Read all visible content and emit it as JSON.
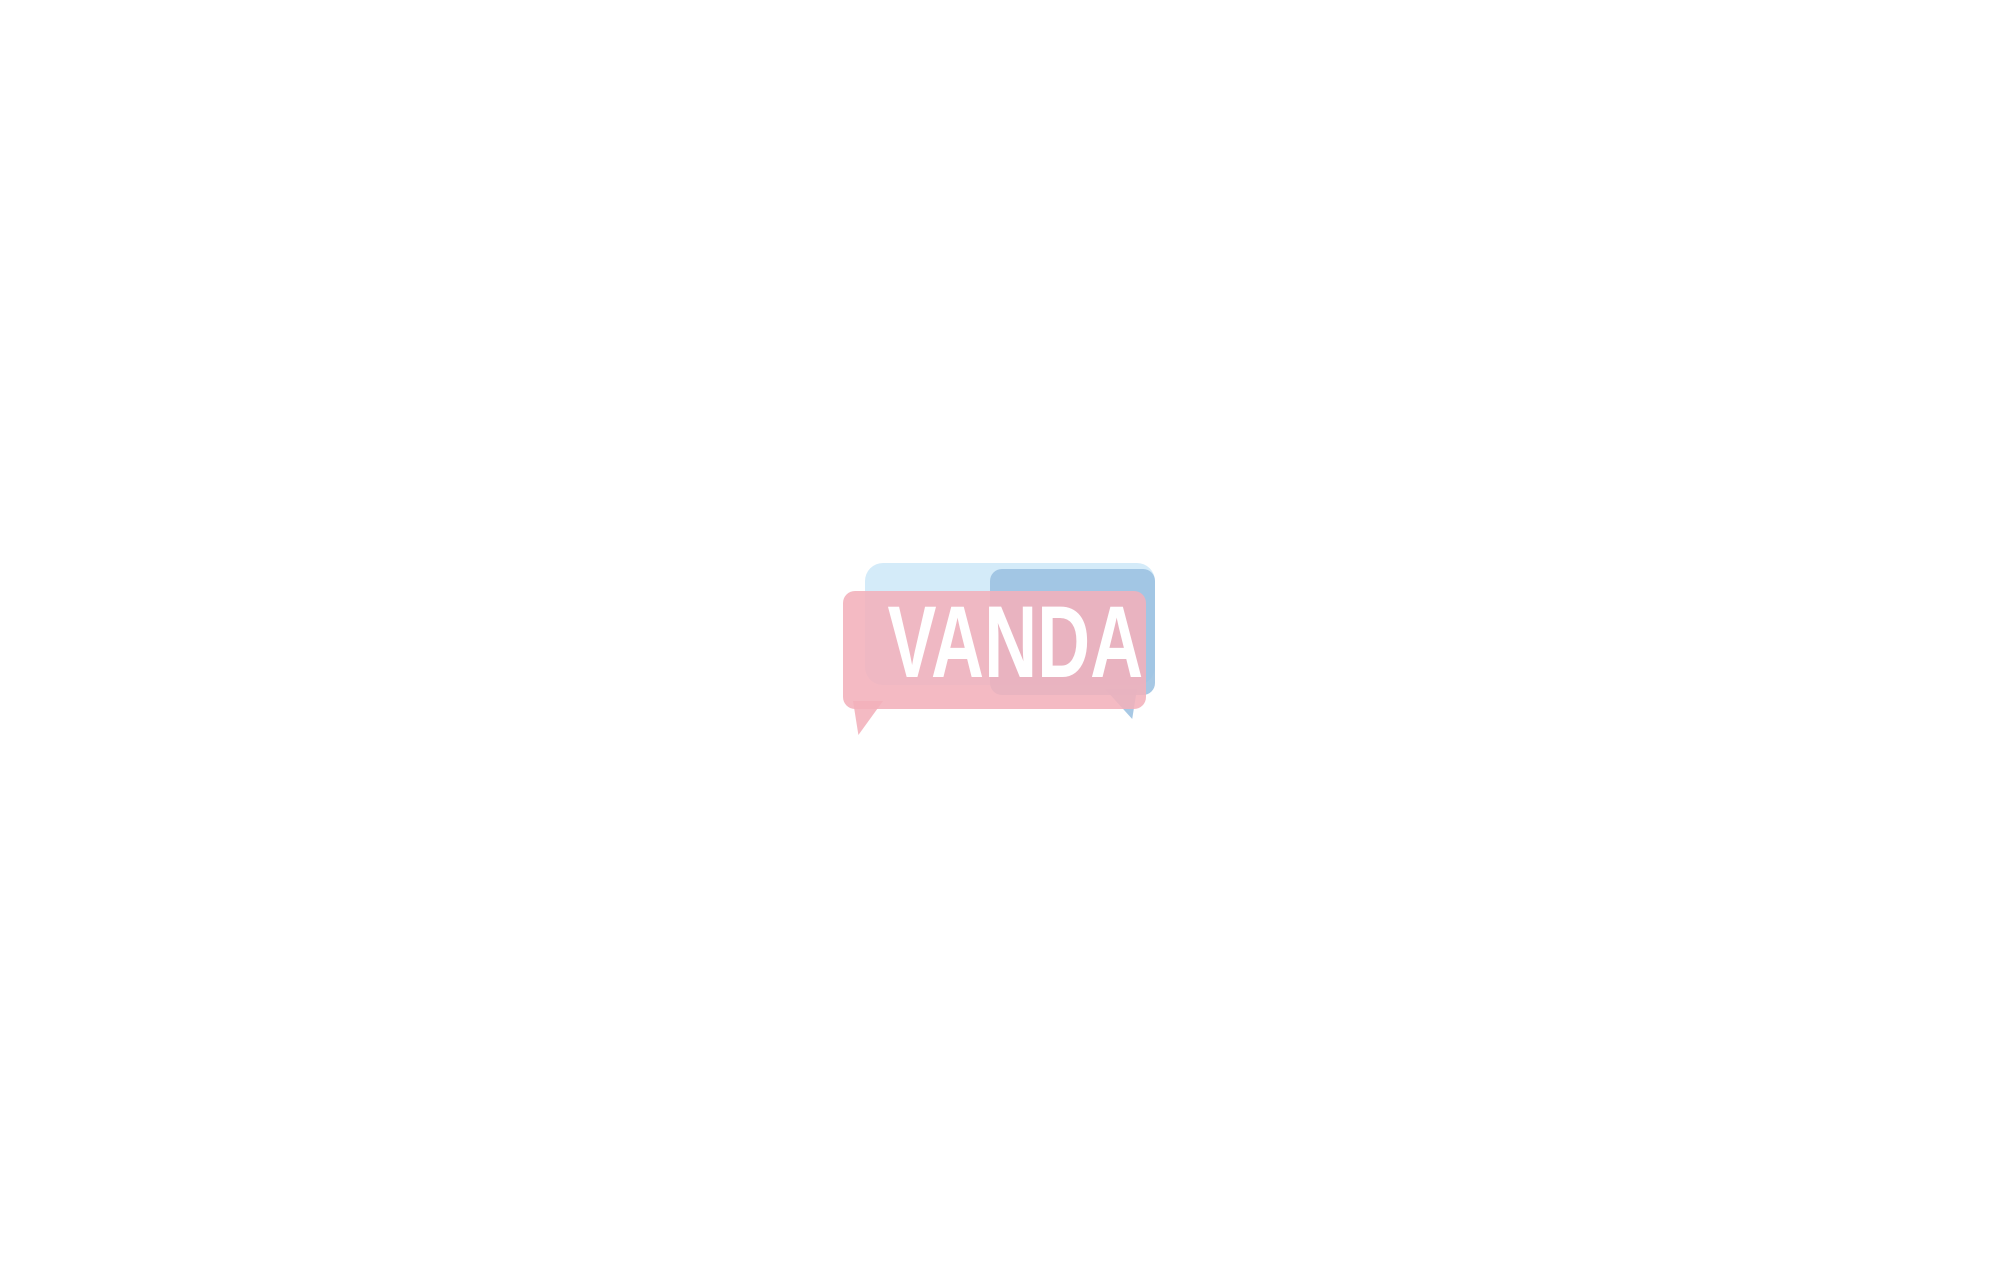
{
  "drawing": {
    "type": "dormitory-floor-plan",
    "watermark": {
      "text": "VANDA"
    },
    "dimensions_top": {
      "total": "24 000",
      "segments": [
        "2 400",
        "2 400",
        "2 400",
        "2 400",
        "2 400",
        "2 400",
        "2 400",
        "2 400",
        "2 400",
        "2 400"
      ]
    },
    "dimensions_left": {
      "total": "14 000",
      "segments": [
        "6 000",
        "2 000",
        "6 000"
      ]
    },
    "counts": {
      "bays": 10,
      "bedroom_bays_per_row": 9,
      "rows": 2,
      "beds": 36,
      "wardrobes": 36,
      "toilet_stalls_per_bathroom": 5,
      "washbasins_per_bathroom": 1,
      "bathrooms": 2
    },
    "colors": {
      "wall_fill": "#a9bdc9",
      "wall_stroke": "#39454f",
      "bed_blanket": "#e4cfd6",
      "bed_frame_yellow": "#ecc254",
      "bed_frame_stroke": "#6b5420",
      "bed_outline": "#4a4038",
      "pillow_white": "#fefefc",
      "wardrobe_fill": "#b2613a",
      "wardrobe_stroke": "#6e3a1d",
      "fixture_stroke": "#1b1b1b",
      "fixture_fill": "#ffffff",
      "line_color": "#111111",
      "dim_text": "#111111",
      "watermark_pink": "rgba(243,177,187,0.88)",
      "watermark_blue": "rgba(155,192,224,0.88)",
      "watermark_lightblue": "rgba(205,232,248,0.85)",
      "watermark_text_color": "#ffffff"
    }
  }
}
